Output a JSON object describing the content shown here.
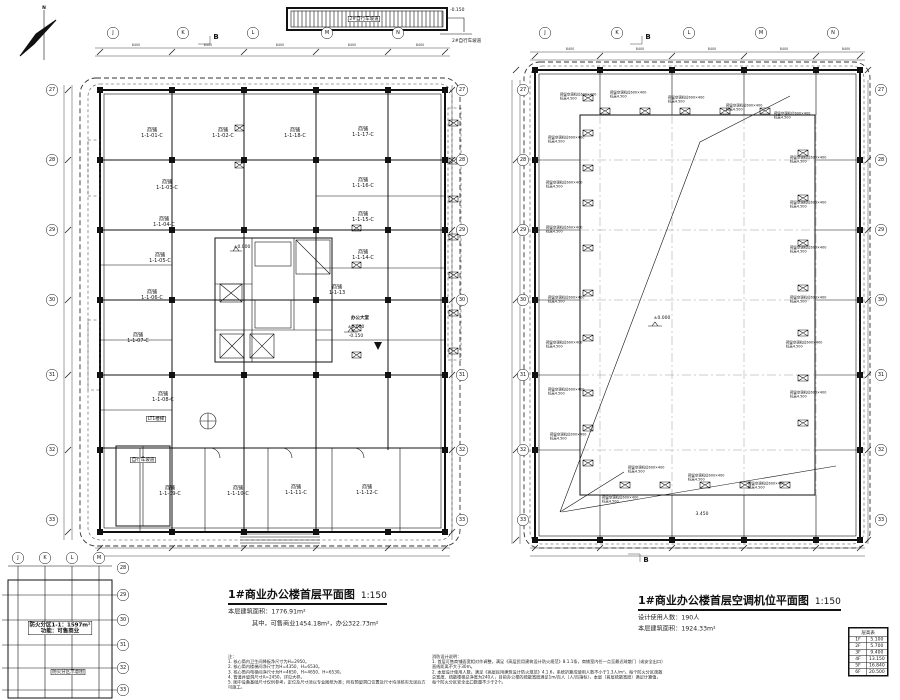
{
  "north_arrow": {
    "label": "N"
  },
  "section_marker": "B",
  "top_ramp": {
    "label": "2#自行车坡道",
    "elevation": "-0.150",
    "side_label": "2#自行车坡道"
  },
  "left_plan": {
    "title": "1#商业办公楼首层平面图",
    "scale": "1:150",
    "area_line1": "本层建筑面积：1776.91m²",
    "area_line2": "其中，可售商业1454.18m²，办公322.73m²",
    "room_prefix": "商铺",
    "rooms": [
      "1-1-01-C",
      "1-1-02-C",
      "1-1-18-C",
      "1-1-17-C",
      "1-1-03-C",
      "1-1-16-C",
      "1-1-04-C",
      "1-1-15-C",
      "1-1-05-C",
      "1-1-14-C",
      "1-1-06-C",
      "1-1-13",
      "1-1-07-C",
      "1-1-08-C",
      "1-1-09-C",
      "1-1-10-C",
      "1-1-11-C",
      "1-1-12-C"
    ],
    "lobby_label": "办公大堂",
    "lobby_elevation": "±0.000",
    "lobby_elevation2": "-0.150",
    "core_elevation": "±0.000",
    "stair_label": "LT1楼梯",
    "ramp_label": "自行车坡道",
    "grid_rows": [
      "27",
      "28",
      "29",
      "30",
      "31",
      "32",
      "33"
    ],
    "grid_cols": [
      "J",
      "K",
      "L",
      "M",
      "N"
    ],
    "bay_dim": "8400"
  },
  "right_plan": {
    "title": "1#商业办公楼首层空调机位平面图",
    "scale": "1:150",
    "info_line1": "设计使用人数：190人",
    "info_line2": "本层建筑面积：1924.33m²",
    "ac_label_line1": "预留空调机位600×400",
    "ac_label_line2": "标高4.500",
    "center_elevation": "±0.000",
    "bottom_dim": "3.450",
    "grid_rows": [
      "27",
      "28",
      "29",
      "30",
      "31",
      "32",
      "33"
    ],
    "grid_cols": [
      "J",
      "K",
      "L",
      "M",
      "N"
    ],
    "bay_dim": "8400"
  },
  "fire_diagram": {
    "line1": "防火分区1-1：1597m²",
    "line2": "功能：可售商业",
    "caption": "防火分区示意图",
    "grid_rows": [
      "28",
      "29",
      "30",
      "31",
      "32",
      "33"
    ],
    "grid_cols": [
      "J",
      "K",
      "L",
      "M"
    ]
  },
  "notes_left": {
    "title": "注：",
    "items": [
      "1. 核心筒内卫生间降板净尺寸为H=2950。",
      "2. 核心筒内楼梯间净尺寸为H=4350、H=6530。",
      "3. 核心筒内电梯间净尺寸为H=4650、H=4650、H=6530。",
      "4. 管道井留洞尺寸A=2450，详见大样。",
      "5. 图中设备基础尺寸仅供参考，定位及尺寸须以专业图纸为准；所有预留洞口位置及尺寸均须核实无误后方可施工。"
    ]
  },
  "notes_right": {
    "title": "消防设计说明：",
    "items": [
      "1. 首层可售商铺面宽相对作调整，满足《高层民用建筑设计防火规范》8.1.1条，商铺室内任一点至最近疏散门（或安全出口）直线距离不大于30m。",
      "2. 本层设计使用人数，满足《高层民用建筑设计防火规范》4.1.6，系统折算成使用人数不小于1.3人/m²。每个防火分区疏散总宽度、疏散楼梯总净宽为240人，目前办公楼的疏散宽度满足1m/百人（人/百指标），本层（首层疏散宽度）满足计算值，每个防火分区安全出口数量不少于2个。"
    ]
  },
  "level_table": {
    "title": "层高表",
    "rows": [
      [
        "1F",
        "5.100"
      ],
      [
        "2F",
        "5.700"
      ],
      [
        "3F",
        "9.400"
      ],
      [
        "4F",
        "13.150"
      ],
      [
        "5F",
        "16.840"
      ],
      [
        "6F",
        "20.500"
      ]
    ]
  }
}
